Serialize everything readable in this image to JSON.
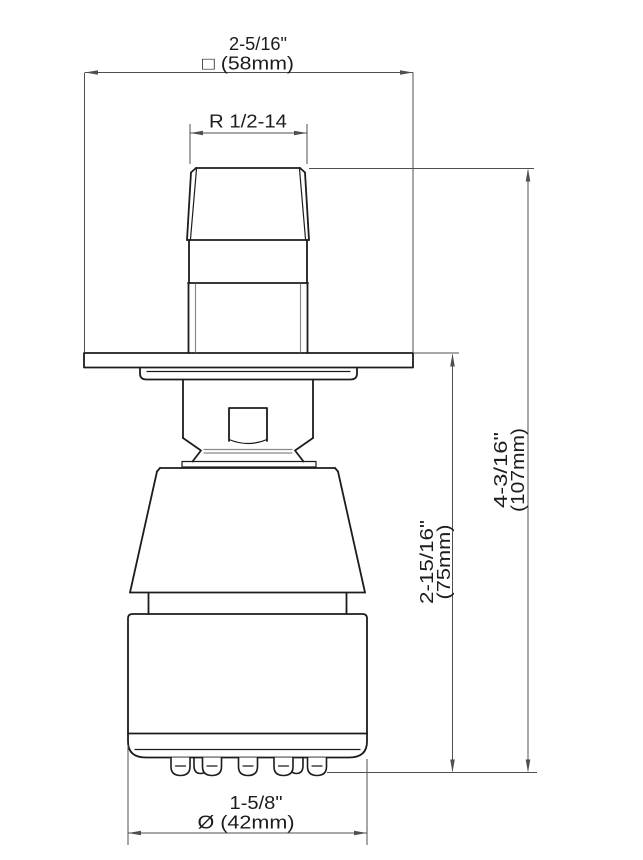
{
  "colors": {
    "object_line": "#1c1c1c",
    "detail_line": "#8a8a8a",
    "dimension_line": "#4f4f4f",
    "text": "#1c1c1c",
    "background": "#ffffff"
  },
  "dimensions": {
    "flange_width": {
      "inches": "2-5/16\"",
      "metric": "□ (58mm)"
    },
    "thread": {
      "label": "R 1/2-14"
    },
    "projection": {
      "inches": "2-15/16\"",
      "metric": "(75mm)"
    },
    "overall_height": {
      "inches": "4-3/16\"",
      "metric": "(107mm)"
    },
    "spray_face_diameter": {
      "inches": "1-5/8\"",
      "metric": "Ø (42mm)"
    }
  }
}
